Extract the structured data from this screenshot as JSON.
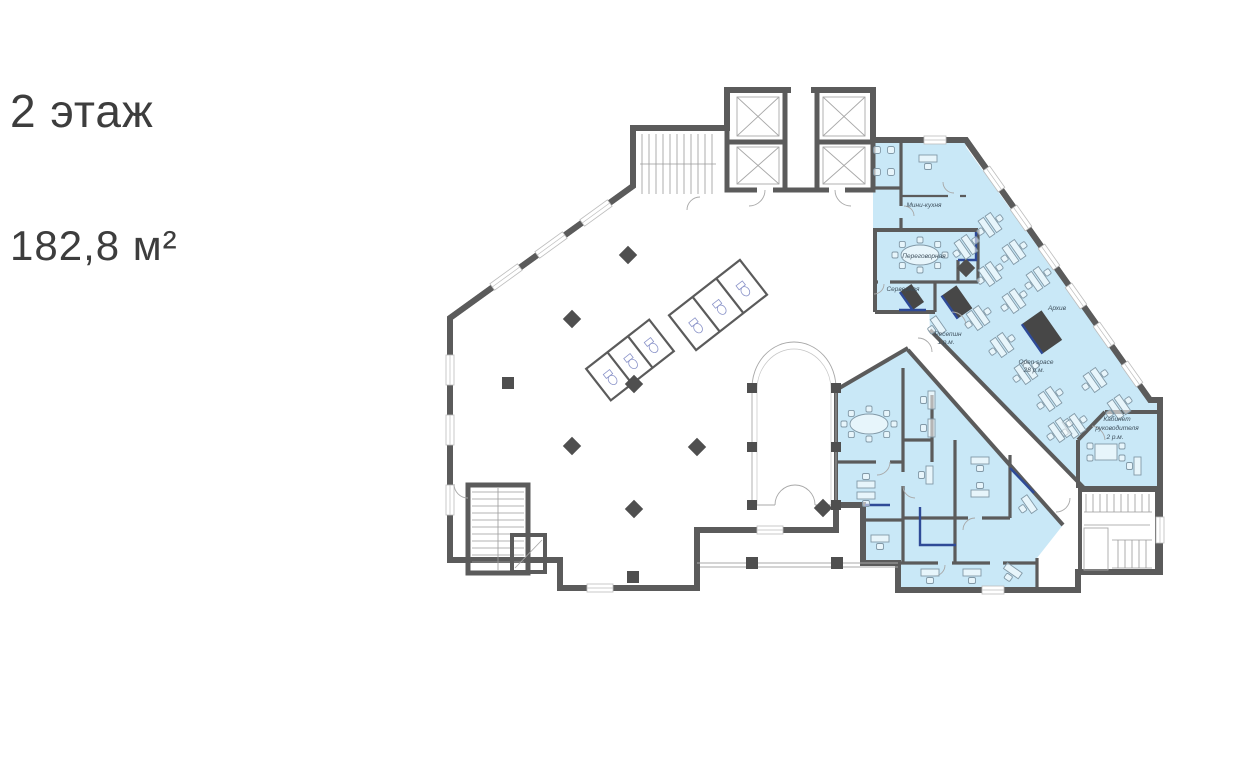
{
  "header": {
    "title": "2 этаж",
    "area": "182,8 м²"
  },
  "plan": {
    "rooms": [
      {
        "id": "mini-kitchen",
        "label": "Мини-кухня"
      },
      {
        "id": "meeting-room",
        "label": "Переговорная"
      },
      {
        "id": "server-room",
        "label": "Серверная"
      },
      {
        "id": "reception",
        "label": "Ресепшн",
        "capacity": "1 р.м."
      },
      {
        "id": "open-space",
        "label": "Open space",
        "capacity": "28 р.м."
      },
      {
        "id": "archive",
        "label": "Архив"
      },
      {
        "id": "director-office",
        "label": "Кабинет",
        "label2": "руководителя",
        "capacity": "2 р.м."
      }
    ],
    "colors": {
      "wall": "#5b5b5b",
      "highlight": "#c9e8f7",
      "accent": "#2e4a97",
      "furniture": "#8299a7",
      "label": "#3e4f5c"
    }
  }
}
